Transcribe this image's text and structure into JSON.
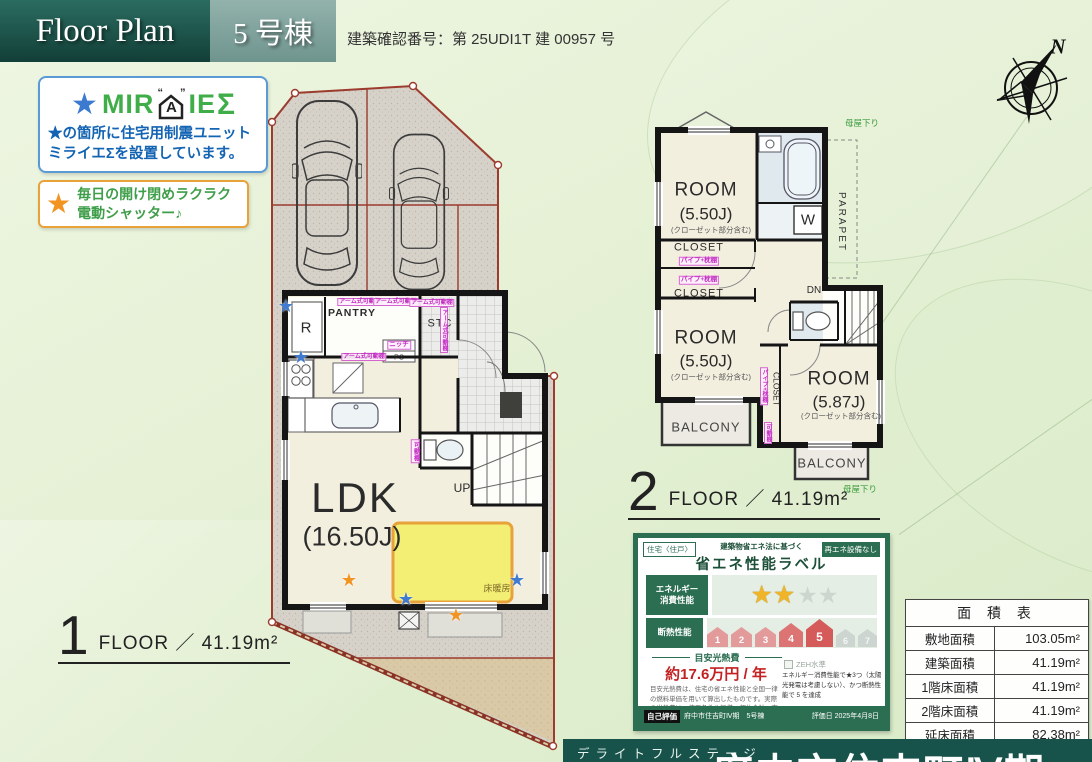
{
  "header": {
    "title": "Floor Plan",
    "unit": "5 号棟",
    "confirmation": "建築確認番号：第 25UDI1T 建 00957 号"
  },
  "miraie": {
    "star": "★",
    "brand_pre": "MIR",
    "brand_a": "A",
    "brand_post": "IE",
    "sigma": "Σ",
    "quote_left": "“",
    "quote_right": "”",
    "desc1": "★の箇所に住宅用制震ユニット",
    "desc2": "ミライエΣを設置しています。"
  },
  "shutter": {
    "star": "★",
    "line1": "毎日の開け閉めラクラク",
    "line2": "電動シャッター♪"
  },
  "compass": {
    "label": "N"
  },
  "floor1": {
    "number": "1",
    "caption": "FLOOR ／ 41.19m²",
    "ldk": "LDK",
    "ldk_size": "(16.50J)",
    "pantry": "PANTRY",
    "stc": "STC",
    "fridge": "R",
    "up": "UP",
    "ps": "PS",
    "niche": "ニッチ",
    "floor_heating": "床暖房",
    "arm_shelf": "アーム式可動棚",
    "movable_shelf": "可動棚"
  },
  "floor2": {
    "number": "2",
    "caption": "FLOOR ／ 41.19m²",
    "room": "ROOM",
    "room1_size": "(5.50J)",
    "room2_size": "(5.50J)",
    "room3_size": "(5.87J)",
    "closet_note": "(クローゼット部分含む)",
    "closet": "CLOSET",
    "pipe_shelf": "パイプ+枕棚",
    "movable_shelf": "可動棚",
    "balcony": "BALCONY",
    "parapet": "PARAPET",
    "dn": "DN",
    "washer": "W",
    "moya_kudari": "母屋下り"
  },
  "energy_label": {
    "tag_dwelling": "住宅〈住戸〉",
    "tag_renewable": "再エネ設備なし",
    "subtitle": "建築物省エネ法に基づく",
    "title": "省エネ性能ラベル",
    "energy_row_label_1": "エネルギー",
    "energy_row_label_2": "消費性能",
    "stars_filled": "★★",
    "stars_empty": "★★",
    "insulation_label": "断熱性能",
    "levels": [
      "1",
      "2",
      "3",
      "4",
      "5",
      "6",
      "7"
    ],
    "cost_title": "目安光熱費",
    "cost_value": "約17.6万円 / 年",
    "zeh": "ZEH水準",
    "note_right": "エネルギー消費性能で★3つ（太陽光発電は考慮しない）、かつ断熱性能で 5 を達成",
    "note_left": "目安光熱費は、住宅の省エネ性能と全国一律の燃料単価を用いて算出したものです。実際の光熱費は、使用条件や設備、契約会社・方法などにより異なります。",
    "self_eval": "自己評価",
    "project": "府中市住吉町Ⅳ期　5号棟",
    "eval_date": "評価日 2025年4月8日"
  },
  "area_table": {
    "title": "面 積 表",
    "rows": [
      {
        "label": "敷地面積",
        "value": "103.05m²"
      },
      {
        "label": "建築面積",
        "value": "41.19m²"
      },
      {
        "label": "1階床面積",
        "value": "41.19m²"
      },
      {
        "label": "2階床面積",
        "value": "41.19m²"
      },
      {
        "label": "延床面積",
        "value": "82.38m²"
      }
    ]
  },
  "footer": {
    "brand": "デライトフルステージ",
    "project": "府中市住吉町Ⅳ期"
  }
}
